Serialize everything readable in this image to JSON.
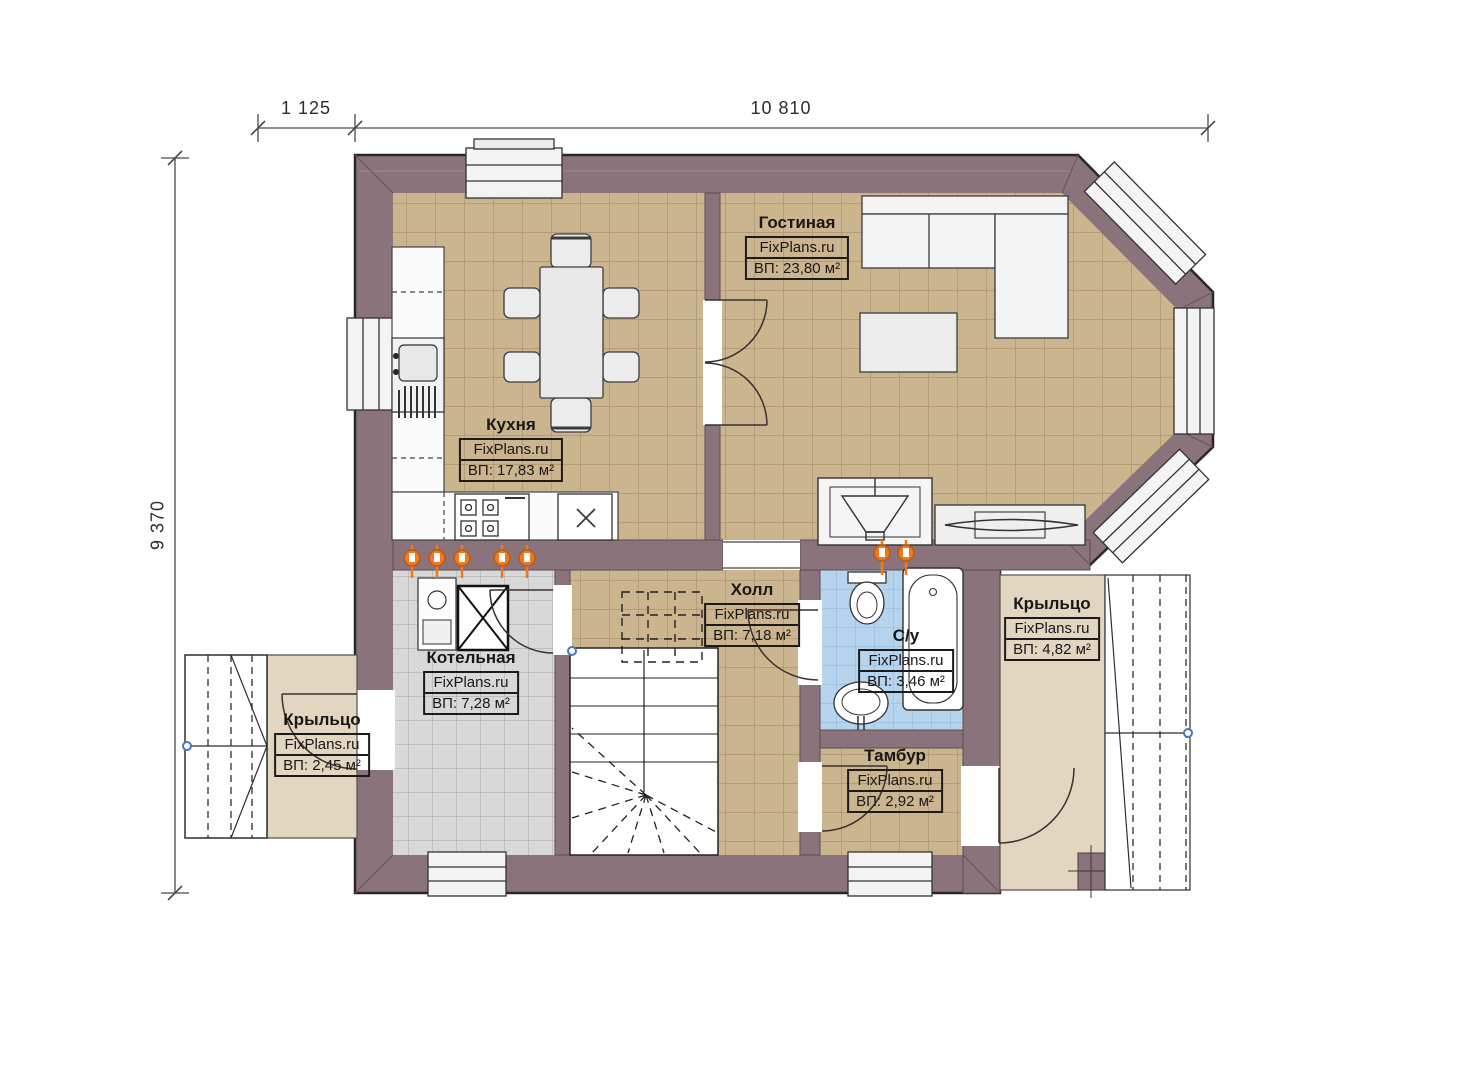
{
  "plan": {
    "kind": "first-floor-plan",
    "watermark": "FixPlans.ru"
  },
  "dimensions": {
    "top_left": "1 125",
    "top_right": "10 810",
    "left": "9 370"
  },
  "rooms": [
    {
      "id": "kitchen",
      "name": "Кухня",
      "watermark": "FixPlans.ru",
      "area": "ВП: 17,83 м²"
    },
    {
      "id": "living-room",
      "name": "Гостиная",
      "watermark": "FixPlans.ru",
      "area": "ВП: 23,80 м²"
    },
    {
      "id": "boiler-room",
      "name": "Котельная",
      "watermark": "FixPlans.ru",
      "area": "ВП: 7,28 м²"
    },
    {
      "id": "hall",
      "name": "Холл",
      "watermark": "FixPlans.ru",
      "area": "ВП: 7,18 м²"
    },
    {
      "id": "bathroom",
      "name": "С/у",
      "watermark": "FixPlans.ru",
      "area": "ВП: 3,46 м²"
    },
    {
      "id": "vestibule",
      "name": "Тамбур",
      "watermark": "FixPlans.ru",
      "area": "ВП: 2,92 м²"
    },
    {
      "id": "porch-left",
      "name": "Крыльцо",
      "watermark": "FixPlans.ru",
      "area": "ВП: 2,45 м²"
    },
    {
      "id": "porch-right",
      "name": "Крыльцо",
      "watermark": "FixPlans.ru",
      "area": "ВП: 4,82 м²"
    }
  ],
  "colors": {
    "wall": "#8b737b",
    "floor_tan": "#cbb58f",
    "floor_gray": "#d8d8d8",
    "floor_blue": "#b7d4ef",
    "porch_beige": "#e3d6c0",
    "valve_orange": "#f07820",
    "marker_blue": "#4575c4"
  }
}
